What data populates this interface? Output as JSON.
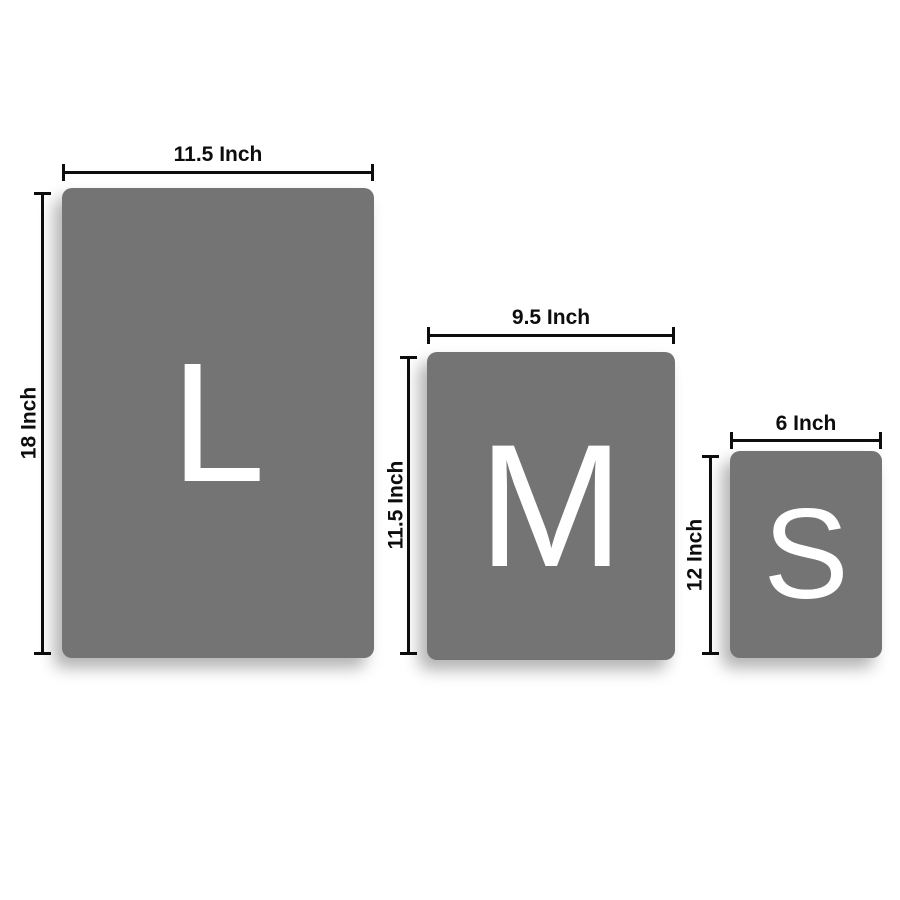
{
  "colors": {
    "background": "#ffffff",
    "panel_fill": "#747474",
    "letter_color": "#ffffff",
    "dimension_color": "#0d0d0d"
  },
  "sizes": [
    {
      "letter": "L",
      "width_label": "11.5 Inch",
      "height_label": "18 Inch"
    },
    {
      "letter": "M",
      "width_label": "9.5 Inch",
      "height_label": "11.5 Inch"
    },
    {
      "letter": "S",
      "width_label": "6 Inch",
      "height_label": "12 Inch"
    }
  ]
}
